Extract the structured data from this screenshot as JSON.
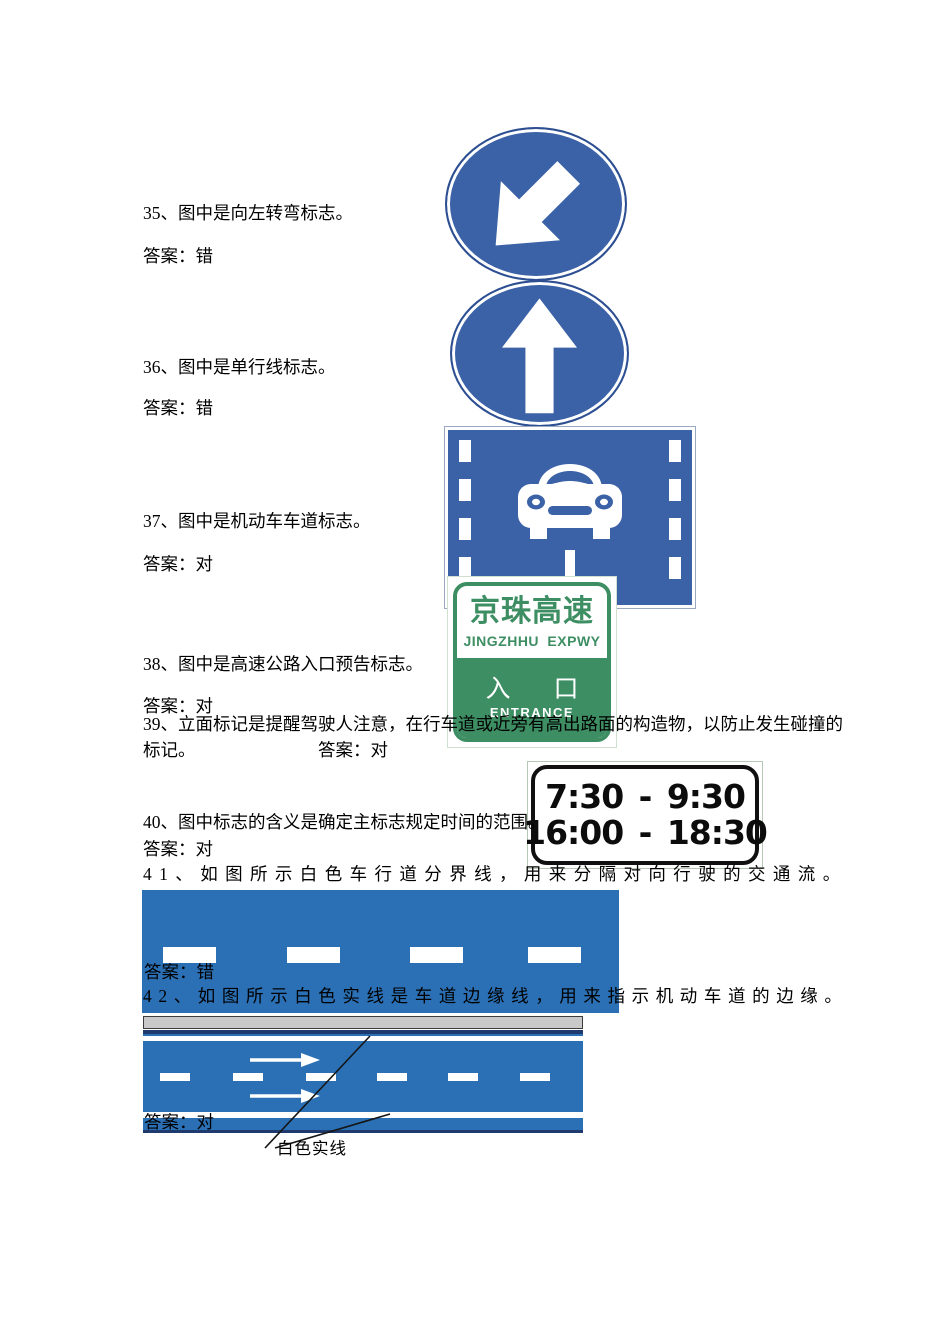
{
  "document": {
    "q35": {
      "text": "35、图中是向左转弯标志。",
      "answer": "答案：错"
    },
    "q36": {
      "text": "36、图中是单行线标志。",
      "answer": "答案：错"
    },
    "q37": {
      "text": "37、图中是机动车车道标志。",
      "answer": "答案：对"
    },
    "q38": {
      "text": "38、图中是高速公路入口预告标志。",
      "answer": "答案：对"
    },
    "q39": {
      "text_line1": "39、立面标记是提醒驾驶人注意，在行车道或近旁有高出路面的构造物，以防止发生碰撞的",
      "text_line2": "标记。",
      "answer": "答案：对"
    },
    "q40": {
      "text": "40、图中标志的含义是确定主标志规定时间的范围。",
      "answer": "答案：对"
    },
    "q41": {
      "text": "41、如图所示白色车行道分界线，用来分隔对向行驶的交通流。",
      "answer": "答案：错"
    },
    "q42": {
      "text": "42、如图所示白色实线是车道边缘线，用来指示机动车道的边缘。",
      "answer": "答案：对",
      "callout_label": "白色实线"
    }
  },
  "signs": {
    "keep_left": {
      "meaning": "keep-left arrow sign"
    },
    "straight_ahead": {
      "meaning": "straight-ahead arrow sign"
    },
    "motor_vehicle_lane": {
      "meaning": "motor vehicle lane sign"
    },
    "expressway": {
      "title": "京珠高速",
      "subtitle": "JINGZHHU EXPWY",
      "entrance_cn": "入 口",
      "entrance_en": "ENTRANCE"
    },
    "time_range": {
      "line1": "7:30 - 9:30",
      "line2": "16:00 - 18:30"
    }
  },
  "colors": {
    "sign_blue": "#3b61a7",
    "road_blue": "#2b70b5",
    "sign_green": "#3e8e63",
    "frame_light_green": "#b5c9b5"
  }
}
